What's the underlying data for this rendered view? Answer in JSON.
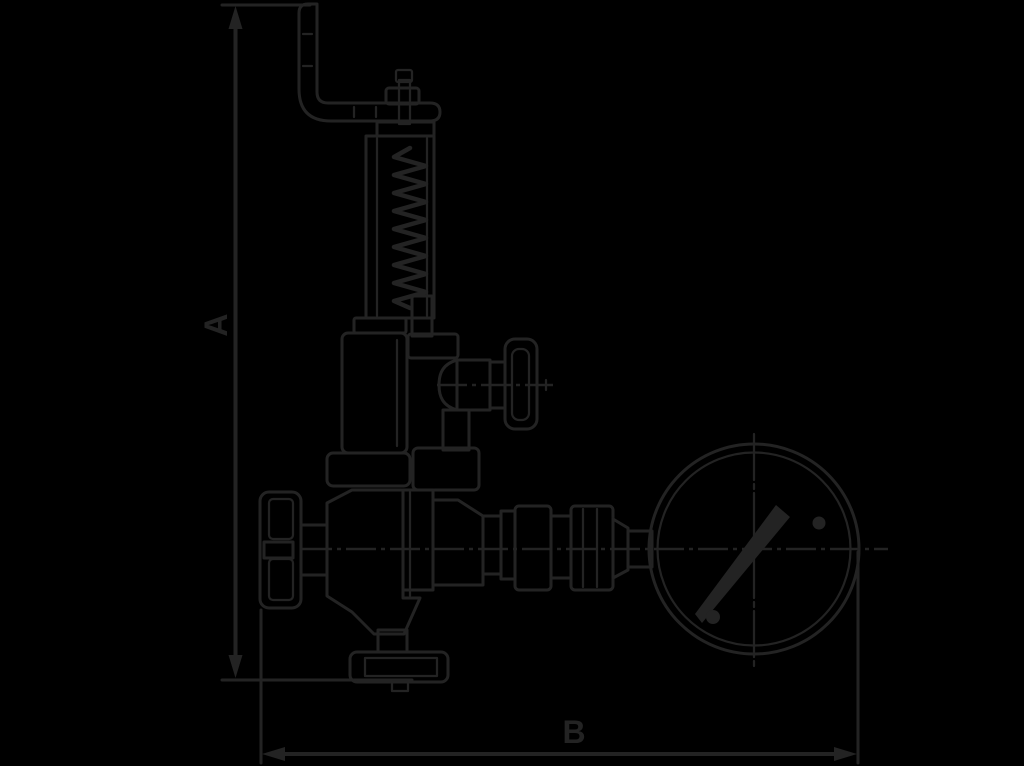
{
  "page": {
    "colors": {
      "background": "#000000",
      "ink": "#232323"
    }
  },
  "diagram": {
    "type": "technical-line-drawing",
    "subject": "adjustable pressure relief valve with lever, handwheel and pressure gauge (side elevation)",
    "dimension_labels": {
      "vertical": "A",
      "horizontal": "B"
    }
  }
}
